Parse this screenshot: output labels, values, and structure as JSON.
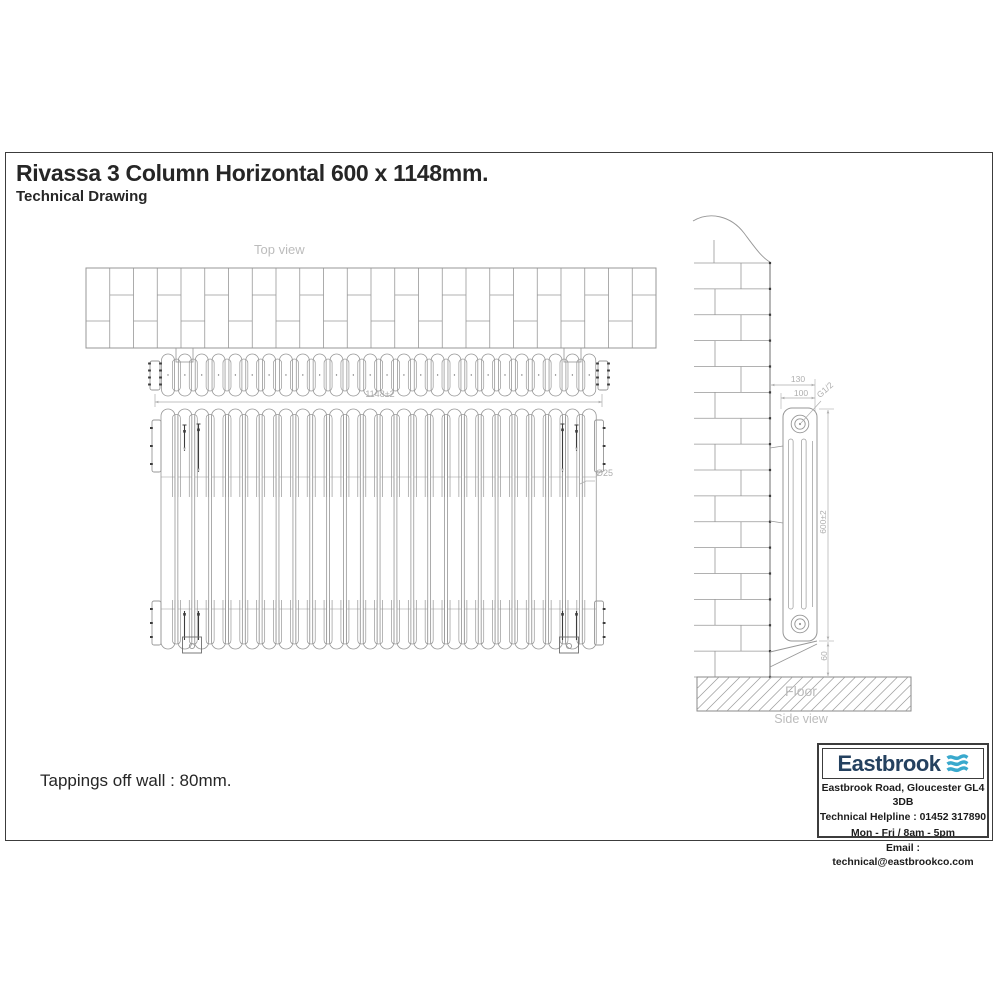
{
  "header": {
    "title": "Rivassa 3 Column Horizontal 600 x 1148mm.",
    "subtitle": "Technical Drawing"
  },
  "note": {
    "text": "Tappings off wall : 80mm."
  },
  "views": {
    "top_label": "Top view",
    "side_label": "Side view",
    "floor_label": "Floor"
  },
  "dimensions": {
    "overall_width": "1148±2",
    "overall_height": "600±2",
    "column_tube": "Ø25",
    "depth_overall": "130",
    "depth_centres": "100",
    "tapping": "G1/2",
    "floor_gap": "60"
  },
  "footer_box": {
    "brand": "Eastbrook",
    "logo_icon": "waves-icon",
    "address": "Eastbrook Road, Gloucester GL4 3DB",
    "helpline": "Technical Helpline : 01452 317890",
    "hours": "Mon - Fri / 8am - 5pm",
    "email": "Email : technical@eastbrookco.com"
  },
  "colors": {
    "line": "#979797",
    "dim": "#aeaeae",
    "label": "#bcbcbc",
    "dark": "#3c3c3c",
    "border": "#3c3c3c",
    "text": "#262626",
    "navy": "#24415f",
    "wave": "#39a9cd"
  }
}
